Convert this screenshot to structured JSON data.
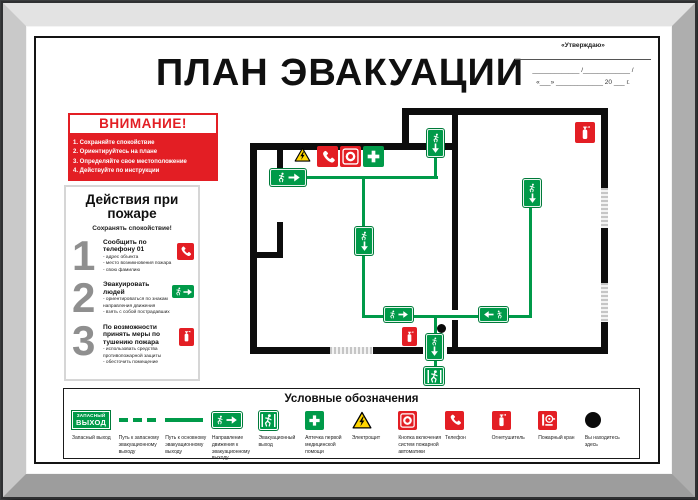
{
  "title": "ПЛАН ЭВАКУАЦИИ",
  "approve": {
    "title": "«Утверждаю»",
    "sig_line": "_____________ /_____________ /",
    "date_line": "«___» _____________ 20 ___ г."
  },
  "attention": {
    "title": "ВНИМАНИЕ!",
    "items": [
      "1. Сохраняйте спокойствие",
      "2. Ориентируйтесь на плане",
      "3. Определяйте свое местоположение",
      "4. Действуйте по инструкции"
    ]
  },
  "actions": {
    "title": "Действия при пожаре",
    "subtitle": "Сохранять спокойствие!",
    "steps": [
      {
        "num": "1",
        "heading": "Сообщить по телефону 01",
        "items": [
          "- адрес объекта",
          "- место возникновения пожара",
          "- свою фамилию"
        ],
        "icon": "phone-icon"
      },
      {
        "num": "2",
        "heading": "Эвакуировать людей",
        "items": [
          "- ориентироваться по знакам направления движения",
          "- взять с собой пострадавших"
        ],
        "icon": "exit-direction-icon"
      },
      {
        "num": "3",
        "heading": "По возможности принять меры по тушению пожара",
        "items": [
          "- использовать средства противопожарной защиты",
          "- обесточить помещение"
        ],
        "icon": "fire-extinguisher-icon"
      }
    ]
  },
  "exit_sign": {
    "line1": "ЗАПАСНЫЙ",
    "line2": "ВЫХОД"
  },
  "plan": {
    "markers": [
      "electric-panel-icon",
      "phone-icon",
      "fire-alarm-button-icon",
      "first-aid-icon",
      "fire-extinguisher-icon",
      "fire-extinguisher-icon",
      "you-are-here-dot"
    ],
    "signs": [
      "exit-direction-right",
      "exit-down",
      "exit-down",
      "exit-down",
      "exit-direction-right",
      "exit-direction-left",
      "exit-down",
      "emergency-exit"
    ]
  },
  "legend": {
    "title": "Условные обозначения",
    "items": [
      {
        "icon": "emergency-exit-sign",
        "label": "Запасный выход"
      },
      {
        "icon": "dashed-route-line",
        "label": "Путь к запасному эвакуационному выходу"
      },
      {
        "icon": "solid-route-line",
        "label": "Путь к основному эвакуационному выходу"
      },
      {
        "icon": "exit-direction-sign",
        "label": "Направление движения к эвакуационному выходу"
      },
      {
        "icon": "evacuation-exit-sign",
        "label": "Эвакуационный выход"
      },
      {
        "icon": "first-aid-icon",
        "label": "Аптечка первой медицинской помощи"
      },
      {
        "icon": "electric-panel-icon",
        "label": "Электрощит"
      },
      {
        "icon": "fire-alarm-button-icon",
        "label": "Кнопка включения систем пожарной автоматики"
      },
      {
        "icon": "phone-icon",
        "label": "Телефон"
      },
      {
        "icon": "fire-extinguisher-icon",
        "label": "Огнетушитель"
      },
      {
        "icon": "fire-hydrant-icon",
        "label": "Пожарный кран"
      },
      {
        "icon": "you-are-here-dot",
        "label": "Вы находитесь здесь"
      }
    ]
  },
  "colors": {
    "green": "#009a49",
    "red": "#e31e24",
    "yellow": "#ffd500",
    "wall": "#0d0d0d",
    "frame": "#c9c9c9"
  }
}
